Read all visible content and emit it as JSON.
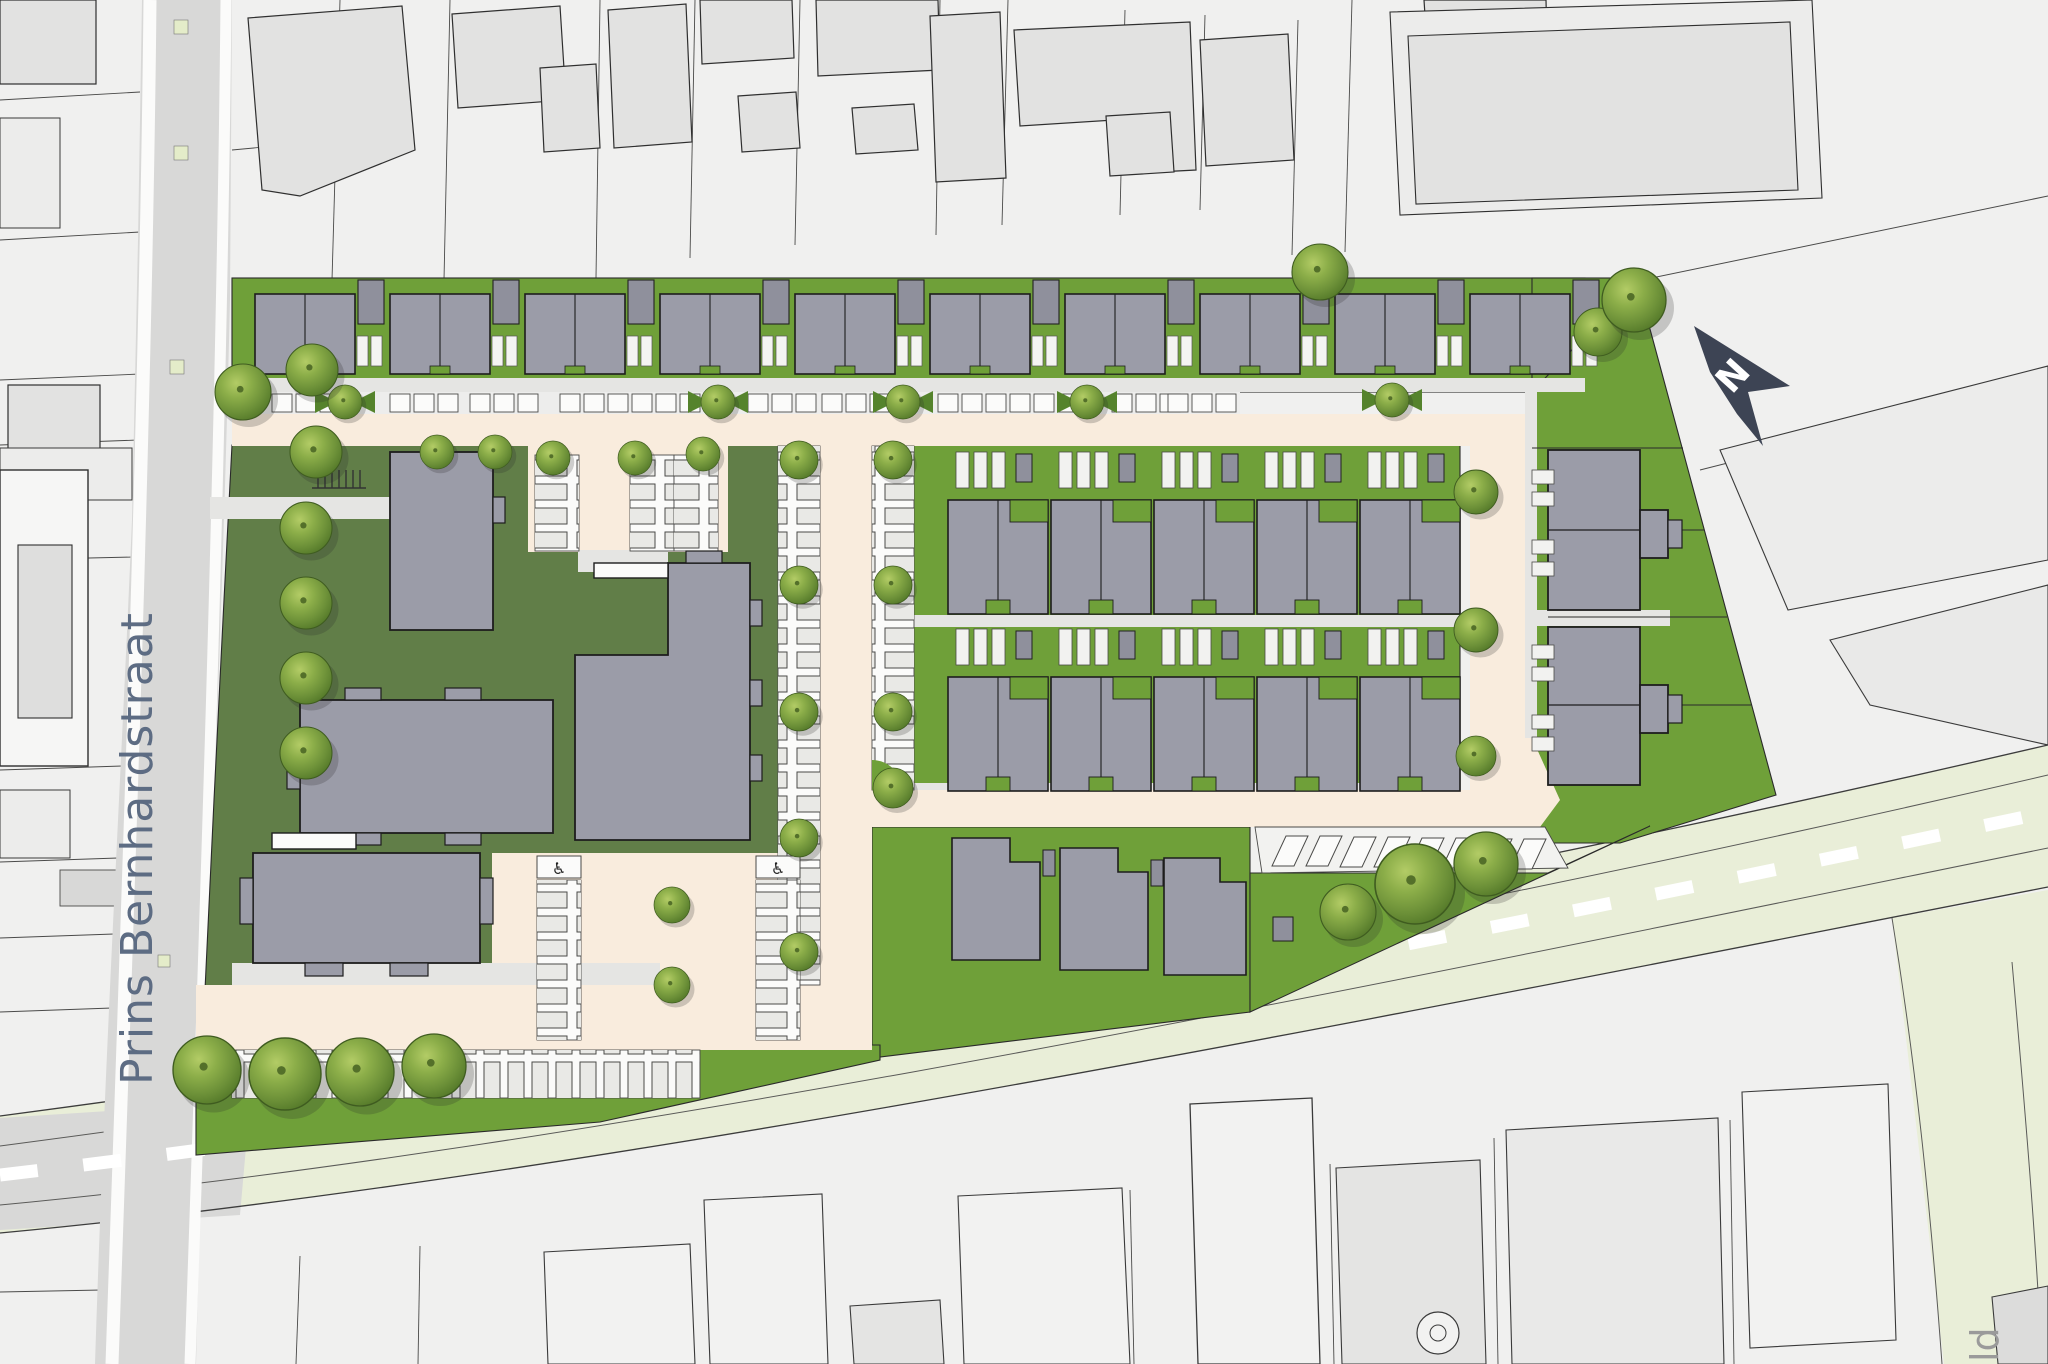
{
  "labels": {
    "street": "Prins Bernhardstraat",
    "north": "N",
    "edge_partial": "ld"
  },
  "icons": {
    "north_arrow": "north-arrow-icon",
    "disabled_parking": "♿",
    "tree": "tree-icon",
    "bike_rack": "bike-rack-icon"
  },
  "colors": {
    "context_background": "#f0f0ef",
    "context_building": "#e2e2e1",
    "street_gray": "#d8d8d7",
    "site_road_cream": "#f9ecdd",
    "garden_green": "#6fa039",
    "lawn_green": "#617e48",
    "building_gray": "#9b9ca8",
    "shed_gray": "#8f909c",
    "main_road_pale": "#e9eed8",
    "north_arrow": "#3d4454",
    "street_label_text": "#5d6c83",
    "tree_green": "#7fa33c"
  }
}
